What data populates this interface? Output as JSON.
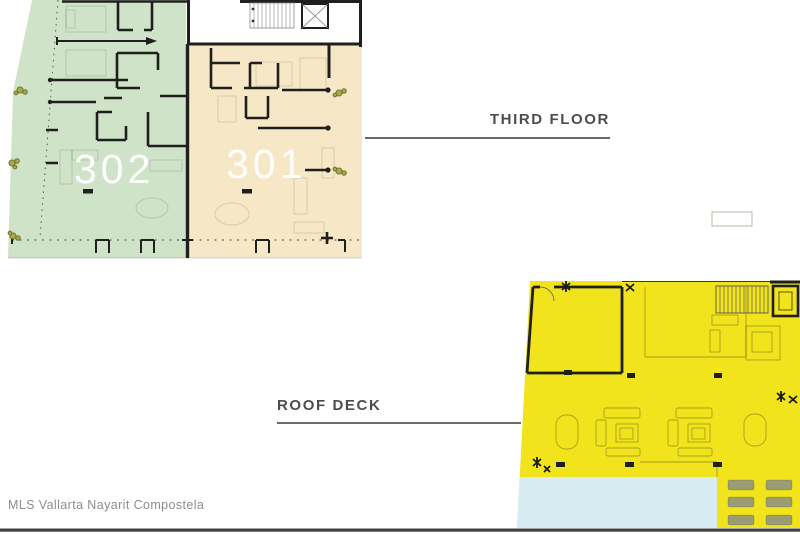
{
  "watermark": "MLS Vallarta Nayarit Compostela",
  "third_floor": {
    "label": "THIRD FLOOR",
    "units": [
      {
        "number": "302",
        "area_color": "#cfe3c8"
      },
      {
        "number": "301",
        "area_color": "#f6e8c6"
      }
    ],
    "core_features": [
      "staircase",
      "elevator"
    ]
  },
  "roof_deck": {
    "label": "ROOF DECK",
    "area_color": "#f1e41d",
    "pool_color": "#d6ebf2",
    "lounger_color": "#9c9c74",
    "features": [
      "covered-room",
      "staircase",
      "elevator",
      "pool",
      "lounge-chairs",
      "seating-groups"
    ]
  },
  "colors": {
    "wall": "#1f1f1d",
    "label_text": "#4d4d4d",
    "label_line": "#555555",
    "watermark_text": "#8d8d8d",
    "bottom_border": "#434343",
    "plant": "#7a7a35"
  }
}
